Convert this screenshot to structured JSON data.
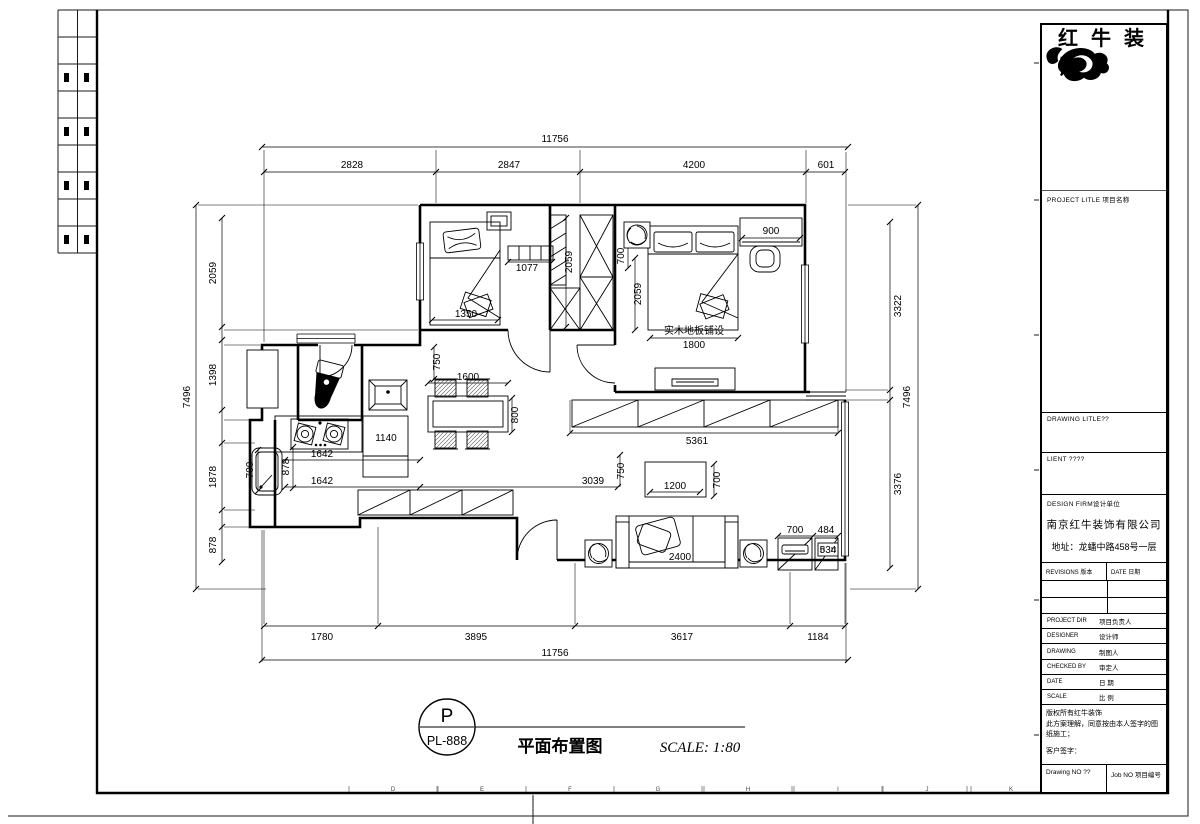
{
  "titleblock": {
    "brand": "红牛装饰",
    "project_title_label": "PROJECT LITLE 项目名称",
    "drawing_title_label": "DRAWING LITLE??",
    "client_label": "LIENT ????",
    "design_firm_label": "DESIGN FIRM设计单位",
    "firm_name": "南京红牛装饰有限公司",
    "firm_address": "地址：龙蟠中路458号一层",
    "revisions_label": "REVISIONS 版本",
    "date_col_label": "DATE 日期",
    "rows": [
      {
        "en": "PROJECT DIR",
        "cn": "项目负责人"
      },
      {
        "en": "DESIGNER",
        "cn": "设计师"
      },
      {
        "en": "DRAWING",
        "cn": "制图人"
      },
      {
        "en": "CHECKED BY",
        "cn": "审定人"
      },
      {
        "en": "DATE",
        "cn": "日 期"
      },
      {
        "en": "SCALE",
        "cn": "比 例"
      }
    ],
    "note_line1": "版权所有红牛装饰",
    "note_line2": "此方案理解，同意按由本人签字的图纸施工；",
    "note_line3": "客户签字：",
    "drawing_no_label": "Drawing NO ??",
    "job_no_label": "Job NO 项目编号"
  },
  "label": {
    "bubble_top": "P",
    "bubble_code": "PL-888",
    "title": "平面布置图",
    "scale": "SCALE: 1:80"
  },
  "plan": {
    "floor_note": "实木地板铺设",
    "dim_texts": [
      {
        "t": "11756",
        "x": 555,
        "y": 142
      },
      {
        "t": "2828",
        "x": 352,
        "y": 168
      },
      {
        "t": "2847",
        "x": 509,
        "y": 168
      },
      {
        "t": "4200",
        "x": 694,
        "y": 168
      },
      {
        "t": "601",
        "x": 826,
        "y": 168
      },
      {
        "t": "1780",
        "x": 322,
        "y": 640
      },
      {
        "t": "3895",
        "x": 476,
        "y": 640
      },
      {
        "t": "3617",
        "x": 682,
        "y": 640
      },
      {
        "t": "1184",
        "x": 818,
        "y": 640
      },
      {
        "t": "11756",
        "x": 555,
        "y": 656
      },
      {
        "t": "2059",
        "x": 216,
        "y": 273,
        "r": -90
      },
      {
        "t": "1398",
        "x": 216,
        "y": 375,
        "r": -90
      },
      {
        "t": "1878",
        "x": 216,
        "y": 477,
        "r": -90
      },
      {
        "t": "878",
        "x": 216,
        "y": 545,
        "r": -90
      },
      {
        "t": "7496",
        "x": 190,
        "y": 397,
        "r": -90
      },
      {
        "t": "3322",
        "x": 901,
        "y": 306,
        "r": -90
      },
      {
        "t": "3376",
        "x": 901,
        "y": 484,
        "r": -90
      },
      {
        "t": "7496",
        "x": 910,
        "y": 397,
        "r": -90
      },
      {
        "t": "1077",
        "x": 527,
        "y": 271
      },
      {
        "t": "1350",
        "x": 466,
        "y": 317
      },
      {
        "t": "2059",
        "x": 572,
        "y": 262,
        "r": -90
      },
      {
        "t": "700",
        "x": 624,
        "y": 256,
        "r": -90
      },
      {
        "t": "2059",
        "x": 641,
        "y": 294,
        "r": -90
      },
      {
        "t": "900",
        "x": 771,
        "y": 234
      },
      {
        "t": "实木地板铺设",
        "x": 694,
        "y": 334,
        "fs": 9
      },
      {
        "t": "1800",
        "x": 694,
        "y": 348
      },
      {
        "t": "750",
        "x": 440,
        "y": 362,
        "r": -90
      },
      {
        "t": "1600",
        "x": 468,
        "y": 380
      },
      {
        "t": "800",
        "x": 518,
        "y": 415,
        "r": -90
      },
      {
        "t": "1140",
        "x": 386,
        "y": 441
      },
      {
        "t": "1642",
        "x": 322,
        "y": 457
      },
      {
        "t": "878",
        "x": 289,
        "y": 467,
        "r": -90
      },
      {
        "t": "700",
        "x": 253,
        "y": 470,
        "r": -90
      },
      {
        "t": "1642",
        "x": 322,
        "y": 484
      },
      {
        "t": "3039",
        "x": 593,
        "y": 484
      },
      {
        "t": "750",
        "x": 624,
        "y": 471,
        "r": -90
      },
      {
        "t": "5361",
        "x": 697,
        "y": 444
      },
      {
        "t": "1200",
        "x": 675,
        "y": 489
      },
      {
        "t": "700",
        "x": 720,
        "y": 480,
        "r": -90
      },
      {
        "t": "2400",
        "x": 680,
        "y": 560
      },
      {
        "t": "700",
        "x": 795,
        "y": 533
      },
      {
        "t": "484",
        "x": 826,
        "y": 533
      },
      {
        "t": "534",
        "x": 828,
        "y": 553,
        "fs": 8
      }
    ],
    "ruler_letters": [
      {
        "t": "D",
        "x": 393
      },
      {
        "t": "E",
        "x": 482
      },
      {
        "t": "F",
        "x": 570
      },
      {
        "t": "G",
        "x": 658
      },
      {
        "t": "H",
        "x": 748
      },
      {
        "t": "I",
        "x": 838
      },
      {
        "t": "J",
        "x": 927
      },
      {
        "t": "K",
        "x": 1011
      }
    ]
  }
}
